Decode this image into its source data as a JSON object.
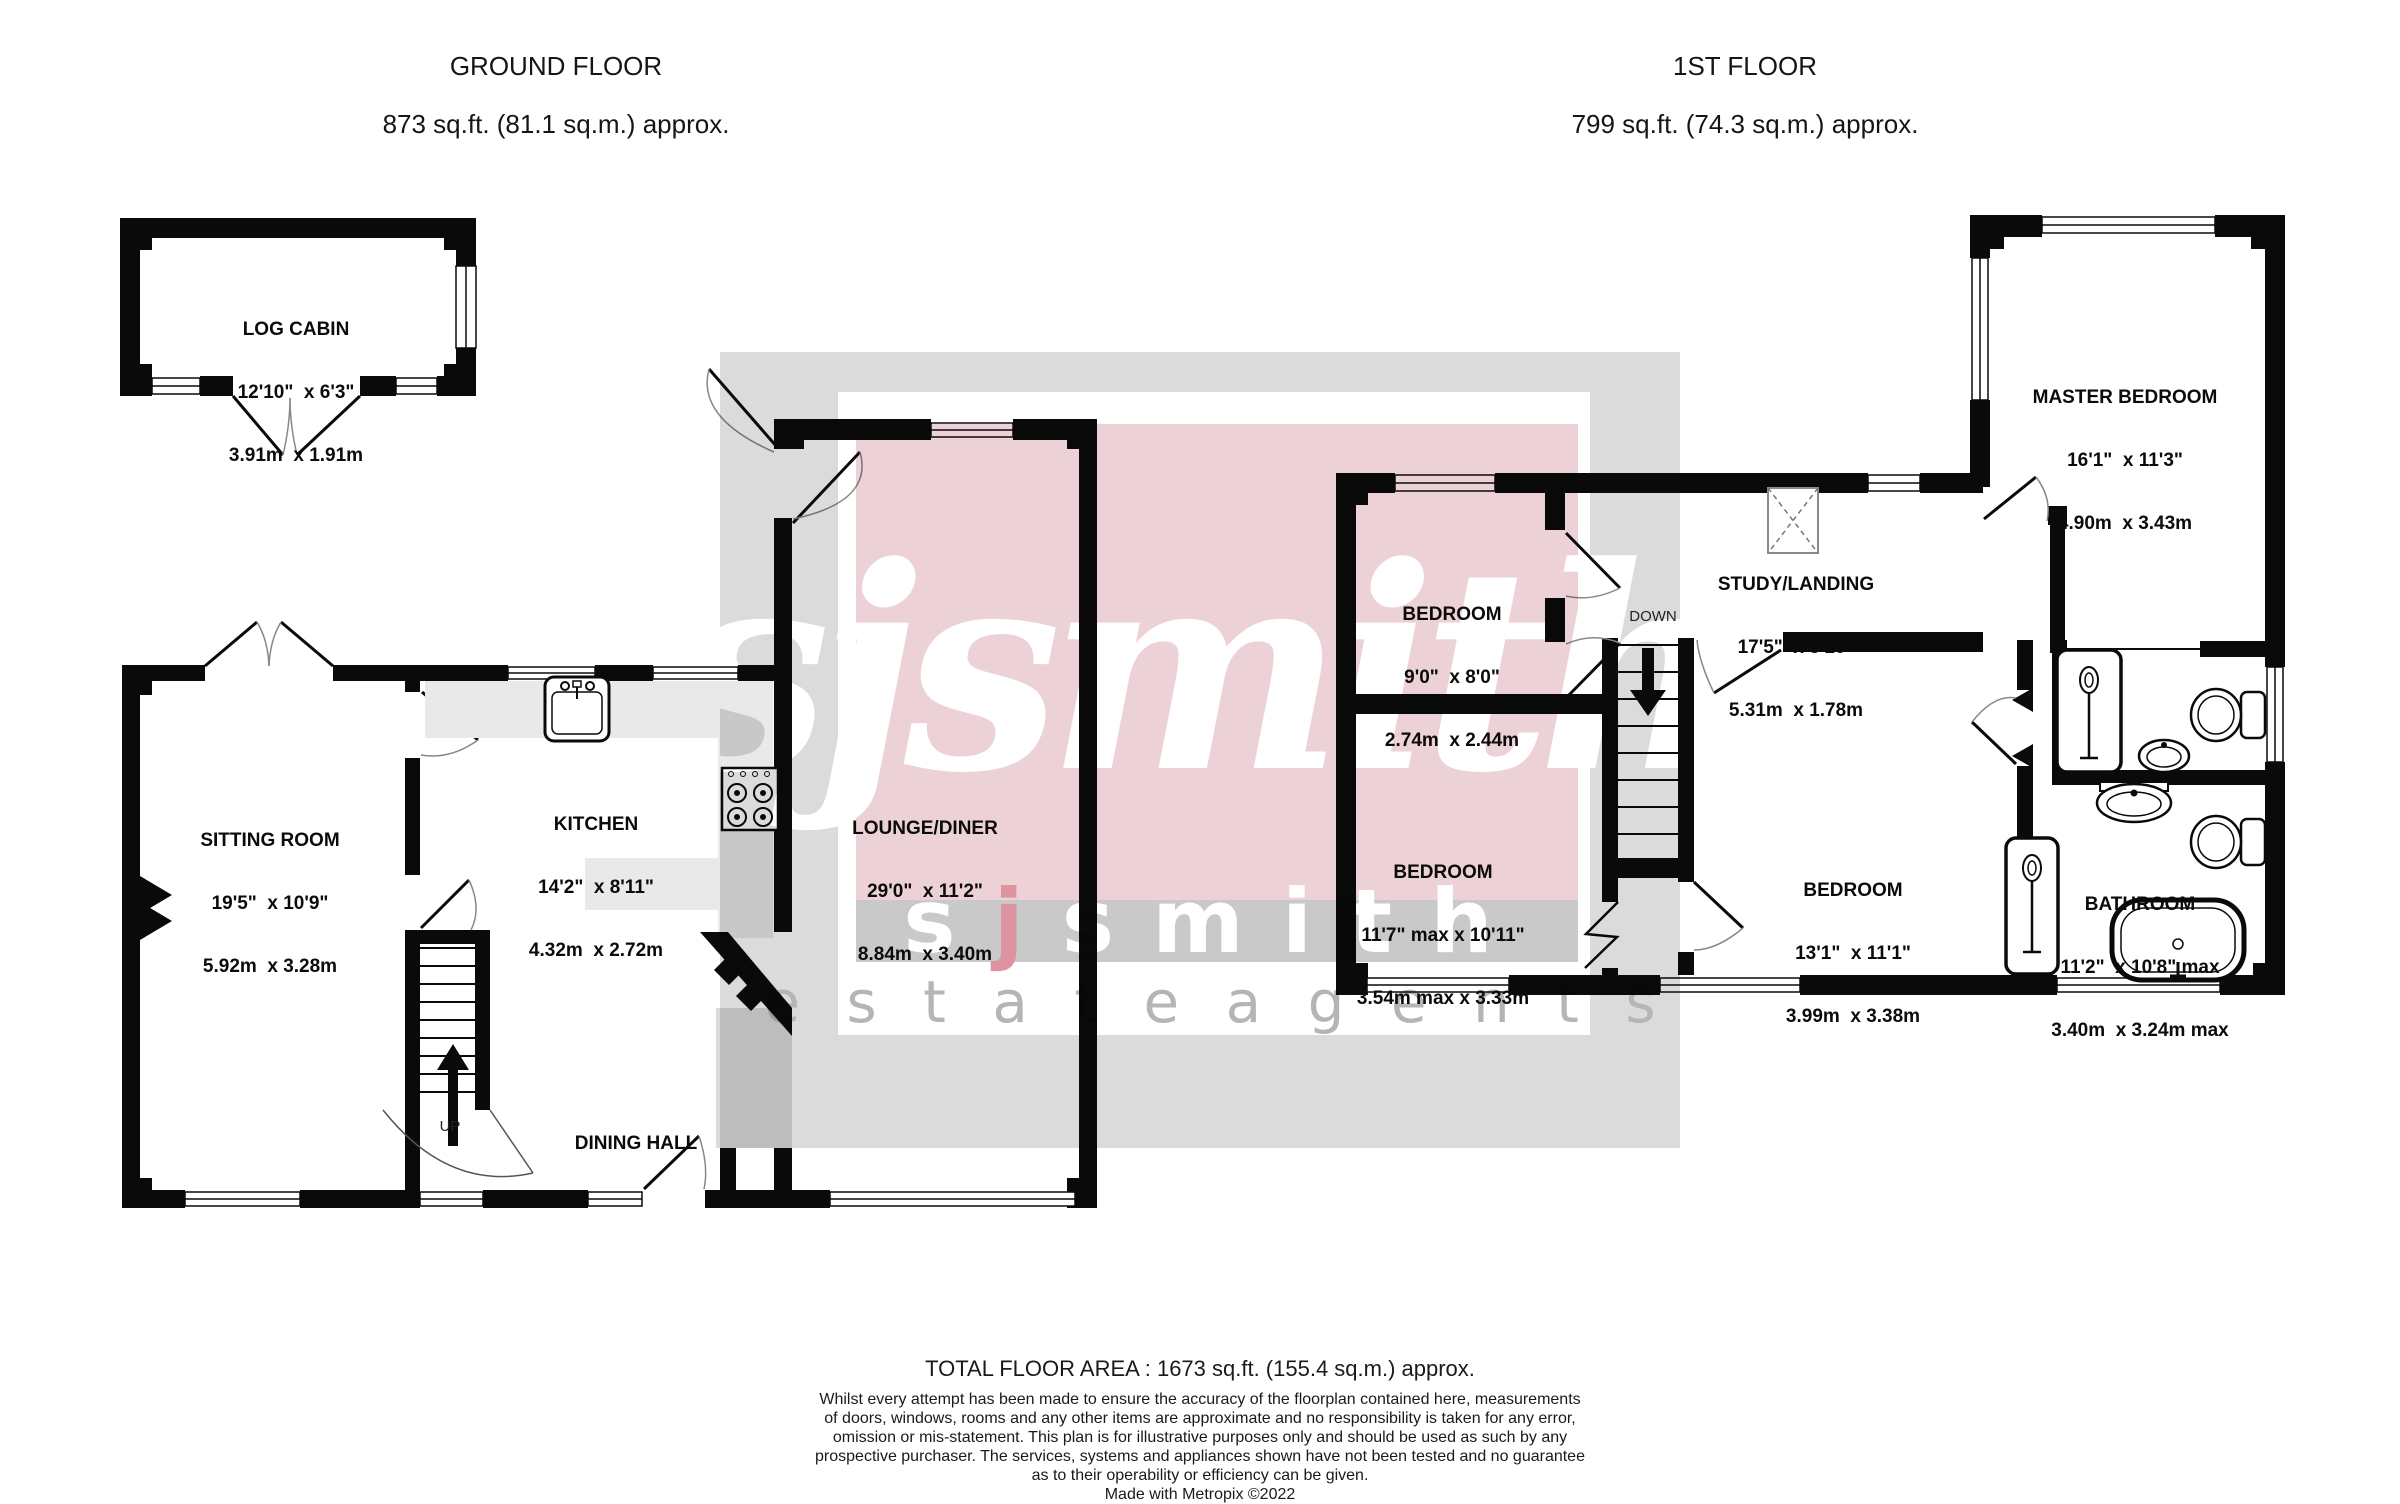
{
  "titles": {
    "ground_line1": "GROUND FLOOR",
    "ground_line2": "873 sq.ft. (81.1 sq.m.) approx.",
    "first_line1": "1ST FLOOR",
    "first_line2": "799 sq.ft. (74.3 sq.m.) approx."
  },
  "rooms": [
    {
      "name": "LOG CABIN",
      "imperial": "12'10\"  x 6'3\"",
      "metric": "3.91m  x 1.91m"
    },
    {
      "name": "SITTING ROOM",
      "imperial": "19'5\"  x 10'9\"",
      "metric": "5.92m  x 3.28m"
    },
    {
      "name": "KITCHEN",
      "imperial": "14'2\"  x 8'11\"",
      "metric": "4.32m  x 2.72m"
    },
    {
      "name": "LOUNGE/DINER",
      "imperial": "29'0\"  x 11'2\"",
      "metric": "8.84m  x 3.40m"
    },
    {
      "name": "DINING HALL",
      "imperial": "",
      "metric": ""
    },
    {
      "name": "BEDROOM",
      "imperial": "9'0\"  x 8'0\"",
      "metric": "2.74m  x 2.44m"
    },
    {
      "name": "STUDY/LANDING",
      "imperial": "17'5\"  x 5'10\"",
      "metric": "5.31m  x 1.78m"
    },
    {
      "name": "MASTER BEDROOM",
      "imperial": "16'1\"  x 11'3\"",
      "metric": "4.90m  x 3.43m"
    },
    {
      "name": "BEDROOM",
      "imperial": "11'7\" max x 10'11\"",
      "metric": "3.54m max x 3.33m"
    },
    {
      "name": "BEDROOM",
      "imperial": "13'1\"  x 11'1\"",
      "metric": "3.99m  x 3.38m"
    },
    {
      "name": "BATHROOM",
      "imperial": "11'2\"  x 10'8\" max",
      "metric": "3.40m  x 3.24m max"
    }
  ],
  "stairs": {
    "up": "UP",
    "down": "DOWN"
  },
  "watermark": {
    "script": "sjsmith",
    "block_pre": "s",
    "block_j": "j",
    "block_post": "smith",
    "tagline": "e s t a t e    a g e n t s",
    "outer_gray": "#dbdbdb",
    "frame_white": "#ffffff",
    "pink": "#ecd2d6",
    "band_gray": "#c9c9c9",
    "tagline_color": "#b5b5b5",
    "accent_j": "#dd93a0",
    "letters_white": "#ffffff"
  },
  "footer": {
    "total": "TOTAL FLOOR AREA : 1673 sq.ft. (155.4 sq.m.) approx.",
    "disclaimer_lines": [
      "Whilst every attempt has been made to ensure the accuracy of the floorplan contained here, measurements",
      "of doors, windows, rooms and any other items are approximate and no responsibility is taken for any error,",
      "omission or mis-statement. This plan is for illustrative purposes only and should be used as such by any",
      "prospective purchaser. The services, systems and appliances shown have not been tested and no guarantee",
      "as to their operability or efficiency can be given.",
      "Made with Metropix ©2022"
    ]
  }
}
